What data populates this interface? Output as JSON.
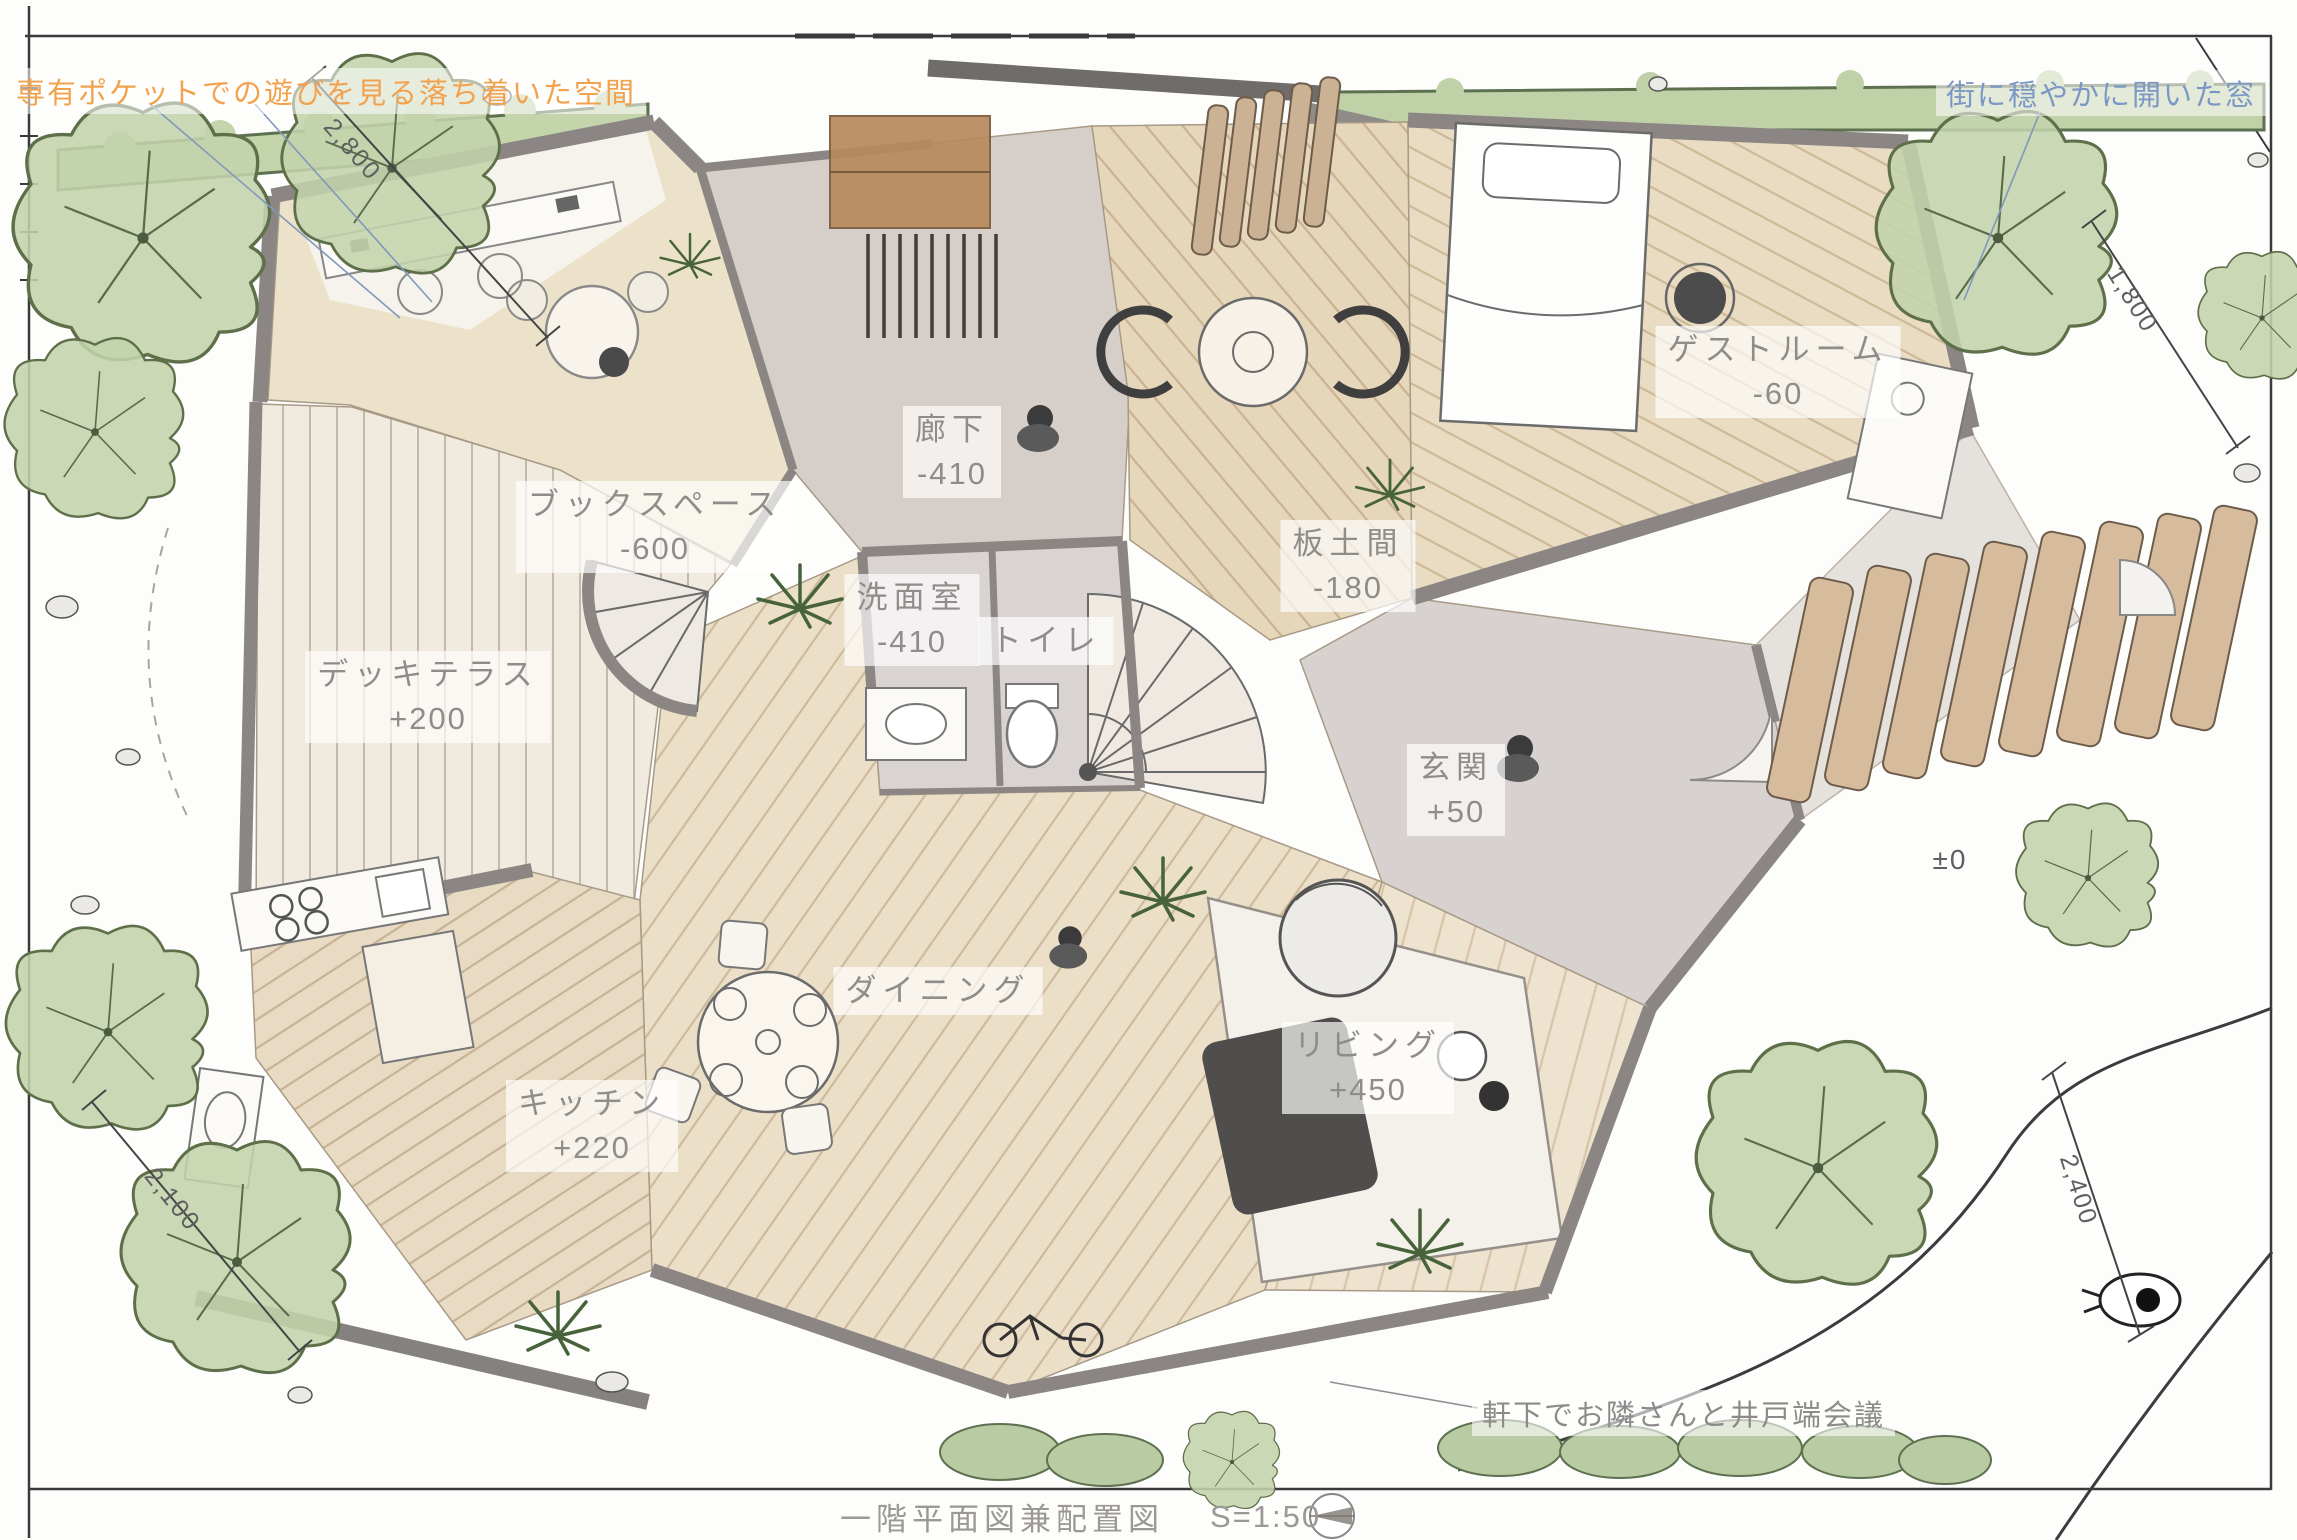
{
  "drawing": {
    "title": "一階平面図兼配置図",
    "scale": "S=1:50"
  },
  "annotations": {
    "top_left_orange": "専有ポケットでの遊びを見る落ち着いた空間",
    "top_right_blue": "街に穏やかに開いた窓",
    "bottom_note": "軒下でお隣さんと井戸端会議"
  },
  "rooms": [
    {
      "name": "ブックスペース",
      "level": "-600"
    },
    {
      "name": "廊下",
      "level": "-410"
    },
    {
      "name": "洗面室",
      "level": "-410"
    },
    {
      "name": "トイレ",
      "level": ""
    },
    {
      "name": "板土間",
      "level": "-180"
    },
    {
      "name": "ゲストルーム",
      "level": "-60"
    },
    {
      "name": "デッキテラス",
      "level": "+200"
    },
    {
      "name": "玄関",
      "level": "+50"
    },
    {
      "name": "ダイニング",
      "level": ""
    },
    {
      "name": "キッチン",
      "level": "+220"
    },
    {
      "name": "リビング",
      "level": "+450"
    }
  ],
  "dimensions": [
    {
      "value": "2,800"
    },
    {
      "value": "1,800"
    },
    {
      "value": "±0"
    },
    {
      "value": "2,100"
    },
    {
      "value": "2,400"
    }
  ],
  "colors": {
    "accent_orange": "#f2a24e",
    "accent_blue": "#7b97c5",
    "wall_gray": "#8b8683",
    "wood_tan": "#e8dac2",
    "tree_green": "#c3d3ab",
    "floor_gray": "#d6d0cc"
  }
}
